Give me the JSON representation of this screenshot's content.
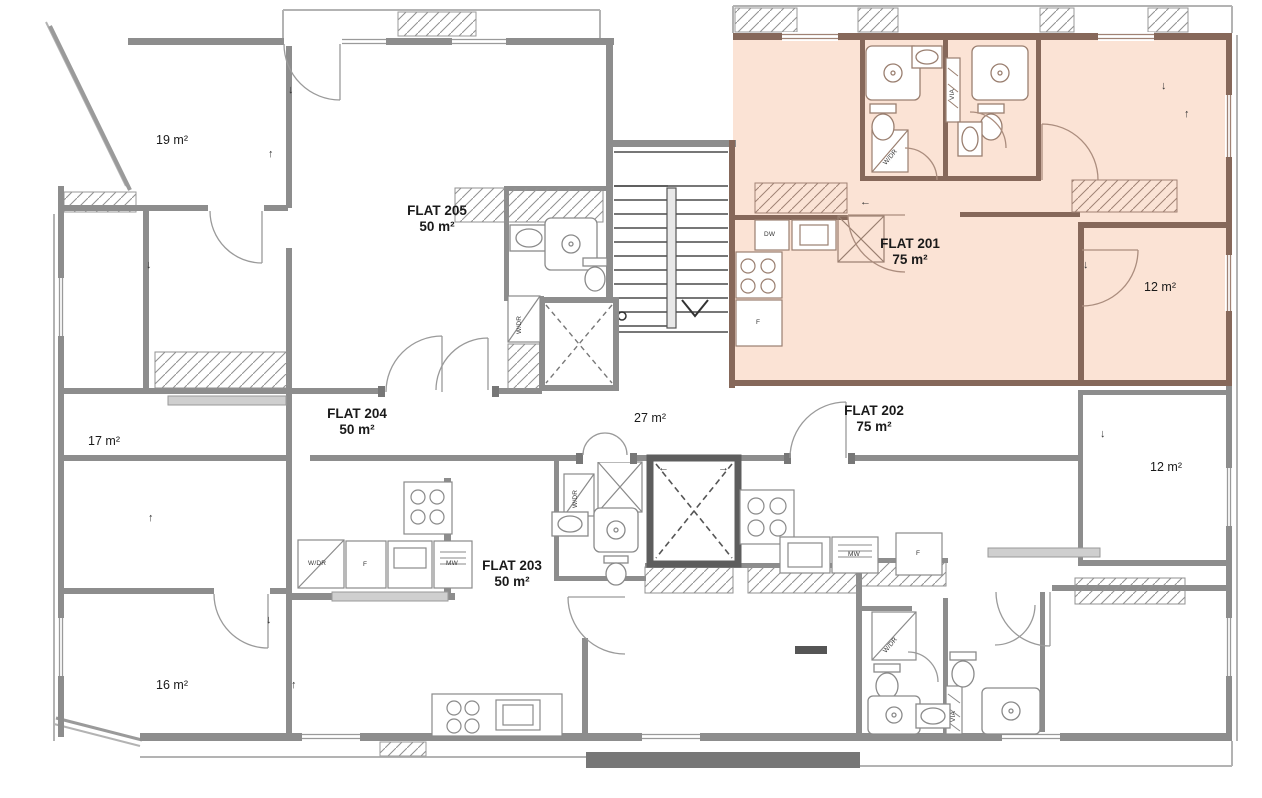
{
  "plan": {
    "flats": [
      {
        "name": "FLAT 201",
        "area": "75 m²",
        "highlighted": true
      },
      {
        "name": "FLAT 202",
        "area": "75 m²",
        "highlighted": false
      },
      {
        "name": "FLAT 203",
        "area": "50 m²",
        "highlighted": false
      },
      {
        "name": "FLAT 204",
        "area": "50 m²",
        "highlighted": false
      },
      {
        "name": "FLAT 205",
        "area": "50 m²",
        "highlighted": false
      }
    ],
    "room_areas": [
      {
        "label": "19 m²"
      },
      {
        "label": "17 m²"
      },
      {
        "label": "16 m²"
      },
      {
        "label": "27 m²"
      },
      {
        "label": "12 m²"
      },
      {
        "label": "12 m²"
      }
    ],
    "fixture_labels": {
      "washer_dryer": "W/DR",
      "dishwasher": "DW",
      "microwave": "MW",
      "fridge": "F",
      "duct": "VIA"
    },
    "arrows": {
      "down": "↓",
      "up": "↑",
      "left": "←",
      "right": "→"
    },
    "colors": {
      "highlight_fill": "#fbe3d5",
      "highlight_wall": "#86685a",
      "wall_gray": "#8d8d8d",
      "wall_dark": "#5d5d5d",
      "balcony_rail": "#b3b3b3",
      "text": "#1a1a1a"
    }
  }
}
